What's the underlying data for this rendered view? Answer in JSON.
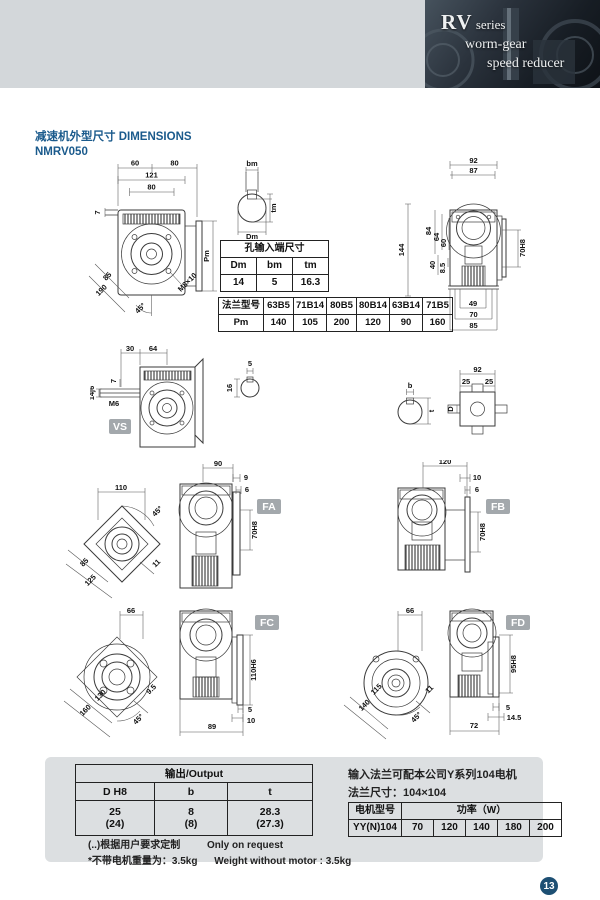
{
  "brand": {
    "rv": "RV",
    "series": "series",
    "line2": "worm-gear",
    "line3": "speed reducer"
  },
  "title": {
    "cn": "减速机外型尺寸",
    "en": "DIMENSIONS",
    "model": "NMRV050"
  },
  "front": {
    "w1": "60",
    "w2": "80",
    "w3": "121",
    "w4": "80",
    "h7": "7",
    "pm": "Pm",
    "diag1": "85",
    "diag2": "190",
    "angle": "45°",
    "bolt": "M8×10"
  },
  "keyway": {
    "bm": "bm",
    "tm": "tm",
    "dm": "Dm"
  },
  "side": {
    "t1": "92",
    "t2": "87",
    "l1": "144",
    "l2": "84",
    "l3": "64",
    "l4": "60",
    "l5": "40",
    "l6": "8.5",
    "bore": "70H8",
    "b1": "49",
    "b2": "70",
    "b3": "85"
  },
  "input_table": {
    "title": "孔输入端尺寸",
    "h": [
      "Dm",
      "bm",
      "tm"
    ],
    "v": [
      "14",
      "5",
      "16.3"
    ]
  },
  "flange_table": {
    "label": "法兰型号",
    "models": [
      "63B5",
      "71B14",
      "80B5",
      "80B14",
      "63B14",
      "71B5"
    ],
    "pm_label": "Pm",
    "pm": [
      "140",
      "105",
      "200",
      "120",
      "90",
      "160"
    ]
  },
  "vs": {
    "badge": "VS",
    "t1": "30",
    "t2": "64",
    "d7": "7",
    "shaft": "14j6",
    "m6": "M6",
    "i1": "5",
    "i2": "16"
  },
  "shaft2": {
    "b": "b",
    "t": "t",
    "d": "D",
    "top": "92",
    "s1": "25",
    "s2": "25"
  },
  "fa": {
    "badge": "FA",
    "sq": "110",
    "angle": "45°",
    "diag1": "85",
    "diag2": "125",
    "key": "11",
    "top": "90",
    "p1": "9",
    "p2": "6",
    "bore": "70H8"
  },
  "fb": {
    "badge": "FB",
    "top": "120",
    "p1": "10",
    "p2": "6",
    "bore": "70H8"
  },
  "fc": {
    "badge": "FC",
    "top": "66",
    "diag1": "130",
    "diag2": "160",
    "key": "9.5",
    "angle": "45°",
    "bore": "110H6",
    "p1": "5",
    "p2": "10",
    "b1": "89"
  },
  "fd": {
    "badge": "FD",
    "top": "66",
    "diag1": "115",
    "diag2": "140",
    "key": "11",
    "angle": "45°",
    "bore": "95H8",
    "p1": "5",
    "p2": "14.5",
    "b1": "72"
  },
  "output_table": {
    "title": "输出/Output",
    "h": [
      "D H8",
      "b",
      "t"
    ],
    "r1": [
      "25",
      "8",
      "28.3"
    ],
    "r2": [
      "(24)",
      "(8)",
      "(27.3)"
    ]
  },
  "notes": {
    "n1cn": "(..)根据用户要求定制",
    "n1en": "Only on request",
    "n2cn": "*不带电机重量为：3.5kg",
    "n2en": "Weight without motor : 3.5kg"
  },
  "motor": {
    "line1": "输入法兰可配本公司Y系列104电机",
    "line2": "法兰尺寸：104×104",
    "col": "电机型号",
    "power": "功率（W）",
    "model": "YY(N)104",
    "values": [
      "70",
      "120",
      "140",
      "180",
      "200"
    ]
  },
  "page": "13",
  "colors": {
    "accent": "#1a5a8c",
    "badge": "#a3a8ac",
    "page_circle": "#1d4f73",
    "header_gray": "#d3d7da"
  }
}
